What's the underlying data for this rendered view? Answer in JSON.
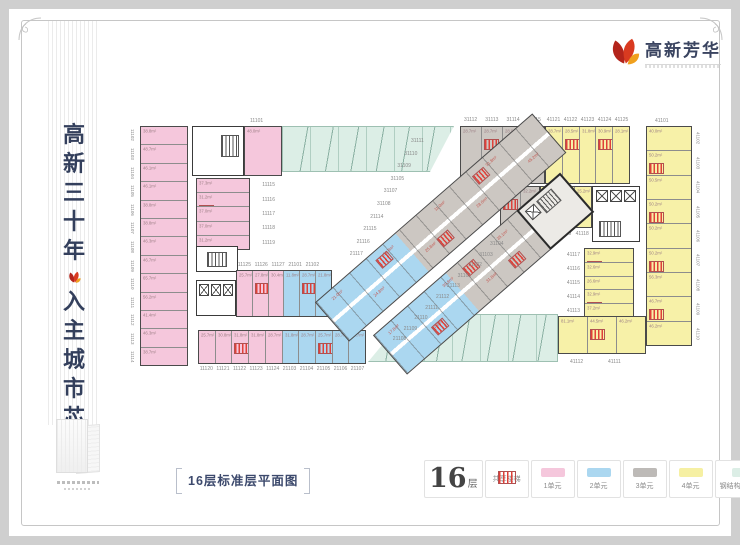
{
  "branding": {
    "tagline": "高新三十年入主城市芯",
    "logo_title": "高新芳华",
    "accent_red": "#c5281c",
    "accent_orange": "#f0a01e",
    "text_navy": "#333f5c"
  },
  "caption": {
    "text": "16层标准层平面图"
  },
  "legend": {
    "floor_number": "16",
    "floor_suffix": "层",
    "items": [
      {
        "label": "共享楼梯",
        "swatch": "hatch"
      },
      {
        "label": "1单元",
        "swatch": "#f5c7dc"
      },
      {
        "label": "2单元",
        "swatch": "#abd7f0"
      },
      {
        "label": "3单元",
        "swatch": "#bdbab7"
      },
      {
        "label": "4单元",
        "swatch": "#f6f0a3"
      },
      {
        "label": "钢结构双面玻璃",
        "swatch": "#dceee6"
      }
    ]
  },
  "plan": {
    "unit1_color": "#f5c7dc",
    "unit2_color": "#abd7f0",
    "unit3_color": "#ccc7c2",
    "unit4_color": "#f7f1a8",
    "glass_color": "#dceee6",
    "stair_color": "#e04038",
    "west": {
      "numbers": [
        "11102",
        "11103",
        "11104",
        "11105",
        "11106",
        "11107",
        "11108",
        "11109",
        "11110",
        "11111",
        "11112",
        "11113",
        "11114"
      ],
      "areas": [
        "38.8m²",
        "48.7m²",
        "46.1m²",
        "46.1m²",
        "38.8m²",
        "38.8m²",
        "46.3m²",
        "46.7m²",
        "65.7m²",
        "56.2m²",
        "41.4m²",
        "46.3m²",
        "38.7m²"
      ]
    },
    "top_unit": {
      "number": "11101",
      "area": "48.0m²"
    },
    "inner_west": {
      "numbers": [
        "11115",
        "11116",
        "11117",
        "11118",
        "11119"
      ],
      "areas": [
        "37.3m²",
        "31.2m²",
        "37.0m²",
        "37.0m²",
        "31.2m²"
      ]
    },
    "top_gray": {
      "numbers": [
        "31112",
        "31113",
        "31114",
        "31115"
      ],
      "areas": [
        "28.7m²",
        "28.7m²",
        "28.9m²",
        "31.8m²"
      ]
    },
    "top_yellow": {
      "numbers": [
        "41121",
        "41122",
        "41123",
        "41124",
        "41125"
      ],
      "areas": [
        "28.7m²",
        "28.5m²",
        "31.8m²",
        "30.9m²",
        "28.1m²"
      ]
    },
    "row2": {
      "numbers": [
        "31117",
        "31116",
        "41120",
        "41119",
        "41118"
      ],
      "areas": [
        "28.4m²",
        "32.2m²",
        "26.4m²",
        "28.0m²",
        "25.2m²"
      ]
    },
    "east": {
      "top_number": "41101",
      "numbers": [
        "41102",
        "41103",
        "41104",
        "41105",
        "41106",
        "41107",
        "41108",
        "41109",
        "41110"
      ],
      "areas": [
        "40.0m²",
        "50.2m²",
        "50.5m²",
        "50.2m²",
        "50.2m²",
        "50.2m²",
        "56.3m²",
        "46.7m²",
        "46.2m²"
      ]
    },
    "inner_east": {
      "numbers": [
        "41117",
        "41116",
        "41115",
        "41114",
        "41113"
      ],
      "areas": [
        "32.9m²",
        "32.6m²",
        "26.6m²",
        "32.9m²",
        "37.2m²"
      ]
    },
    "bottom_right": {
      "numbers": [
        "41112",
        "41111"
      ],
      "areas": [
        "81.1m²",
        "44.5m²",
        "46.2m²"
      ]
    },
    "bottom_upper": {
      "numbers": [
        "11125",
        "11126",
        "11127",
        "21101",
        "21102"
      ],
      "areas": [
        "25.7m²",
        "27.8m²",
        "30.4m²",
        "11.8m²",
        "28.7m²",
        "21.8m²"
      ]
    },
    "bottom_lower": {
      "numbers": [
        "11120",
        "11121",
        "11122",
        "11123",
        "11124",
        "21103",
        "21104",
        "21105",
        "21106",
        "21107"
      ],
      "areas": [
        "25.7m²",
        "30.8m²",
        "31.8m²",
        "31.8m²",
        "28.7m²",
        "31.8m²",
        "28.7m²",
        "25.7m²",
        "28.7m²",
        "30.7m²"
      ]
    },
    "diag_a": {
      "numbers": [
        "31111",
        "31110",
        "31109",
        "31105",
        "31107",
        "31108",
        "21114",
        "21115",
        "21116",
        "21117"
      ],
      "areas": [
        "21.0m²",
        "24.8m²",
        "31.8m²",
        "25.8m²",
        "11.0m²",
        "28.0m²",
        "31.8m²",
        "45.2m²"
      ]
    },
    "diag_b": {
      "numbers": [
        "31104",
        "31103",
        "31102",
        "31101",
        "21113",
        "21112",
        "21111",
        "21110",
        "21109",
        "21108"
      ],
      "areas": [
        "17.8m²",
        "21.8m²",
        "30.8m²",
        "31.8m²",
        "35.1m²"
      ]
    }
  }
}
